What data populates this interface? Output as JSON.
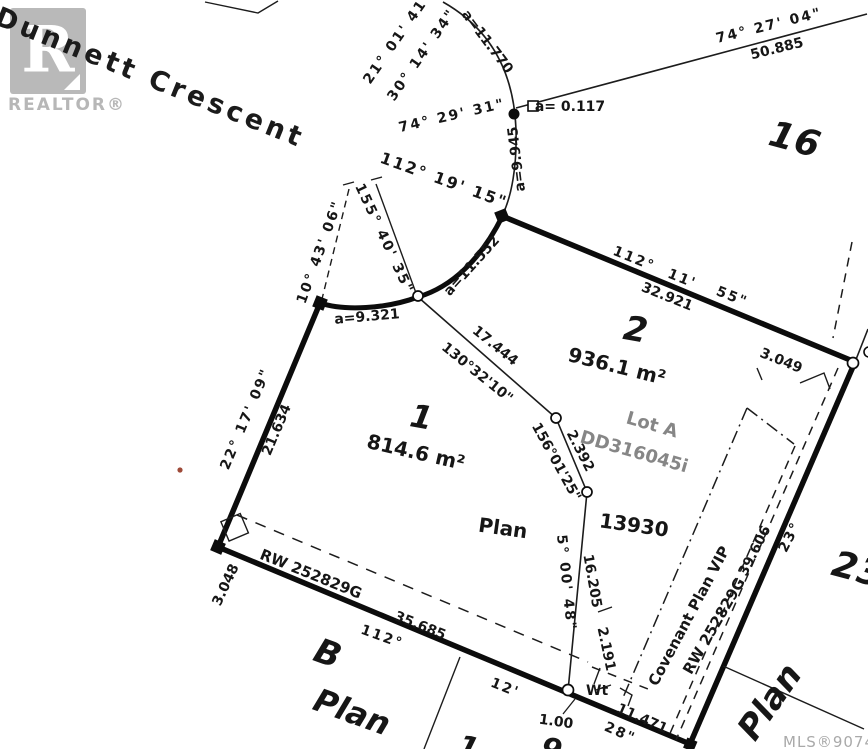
{
  "street": {
    "name": "Dunnett Crescent"
  },
  "watermark": {
    "logo_letter": "R",
    "realtor_text": "REALTOR®"
  },
  "mls_number": "MLS®907448",
  "lots": {
    "lot1": {
      "number": "1",
      "area": "814.6 m²"
    },
    "lot2": {
      "number": "2",
      "area": "936.1 m²"
    },
    "lot16": {
      "number": "16"
    },
    "lot23": {
      "number": "23"
    },
    "lotB": {
      "number": "B"
    },
    "lotA": {
      "label": "Lot A",
      "document": "DD316045i"
    },
    "plan_word_center": "Plan",
    "plan_number": "13930",
    "plan_word_b": "Plan",
    "plan_word_right": "Plan",
    "partial_lot_1": "1",
    "partial_lot_9": "9"
  },
  "bearings": {
    "b_21_01_41": "21° 01' 41\"",
    "b_30_14_34": "30° 14' 34\"",
    "b_74_29_31": "74° 29' 31\"",
    "b_74_27_04": "74° 27' 04\"",
    "b_112_19_15": "112° 19' 15\"",
    "b_155_40_35": "155° 40' 35\"",
    "b_10_43_06": "10° 43' 06\"",
    "b_112_11_55_p1": "112°",
    "b_112_11_55_p2": "11'",
    "b_112_11_55_p3": "55\"",
    "b_130_32_10": "130°32'10\"",
    "b_156_01_25": "156°01'25\"",
    "b_22_17_09": "22° 17' 09\"",
    "b_5_00_48": "5° 00' 48\"",
    "b_112_bottom": "112°",
    "b_12_bottom": "12'",
    "b_28_bottom": "28\"",
    "b_23_right": "23°"
  },
  "distances": {
    "d_50_885": "50.885",
    "d_32_921": "32.921",
    "d_17_444": "17.444",
    "d_2_392": "2.392",
    "d_21_634": "21.634",
    "d_16_205": "16.205",
    "d_2_191": "2.191",
    "d_35_685": "35.685",
    "d_11_471": "11.471",
    "d_1_00": "1.00",
    "d_39_606": "39.606",
    "d_3_049": "3.049",
    "d_3_048": "3.048"
  },
  "arcs": {
    "a_11_770": "a=11.770",
    "a_0_117": "a= 0.117",
    "a_9_945": "a=9.945",
    "a_11_552": "a=11.552",
    "a_9_321": "a=9.321"
  },
  "easements": {
    "rw_bottom": "RW 252829G",
    "rw_right": "RW 252829G",
    "covenant": "Covenant Plan VIP"
  },
  "markers": {
    "witness_post": "Wt"
  }
}
